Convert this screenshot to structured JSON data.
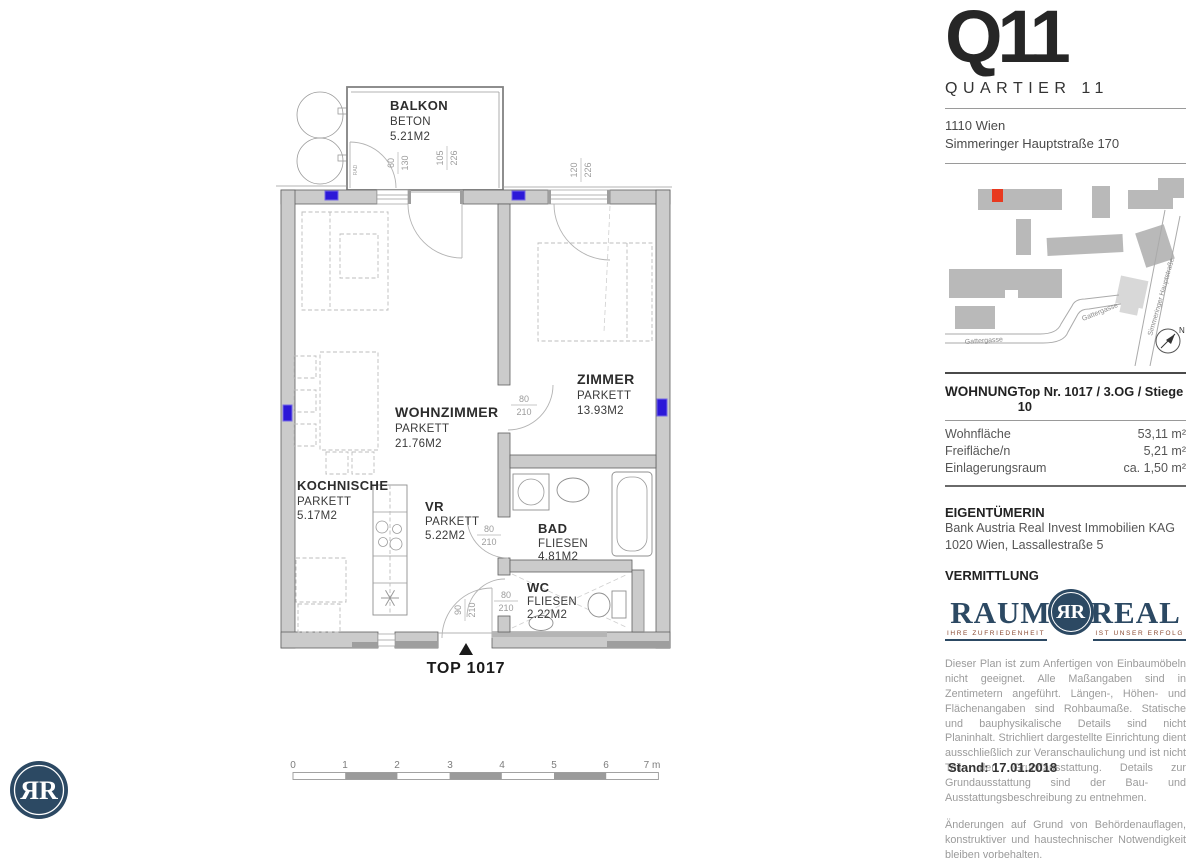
{
  "colors": {
    "brand_navy": "#2c4963",
    "marker_red": "#e8391f",
    "outlet_blue": "#2c18d8"
  },
  "header": {
    "logo": "Q11",
    "subtitle": "QUARTIER 11",
    "address_line1": "1110 Wien",
    "address_line2": "Simmeringer Hauptstraße 170"
  },
  "site_map": {
    "street_gattergasse_1": "Gattergasse",
    "street_gattergasse_2": "Gattergasse",
    "street_hauptstrasse": "Simmeringer Hauptstraße",
    "compass": "N"
  },
  "unit_info": {
    "section_label": "WOHNUNG",
    "unit_label": "Top Nr. 1017 / 3.OG / Stiege 10",
    "rows": [
      {
        "label": "Wohnfläche",
        "value": "53,11 m²"
      },
      {
        "label": "Freifläche/n",
        "value": "5,21 m²"
      },
      {
        "label": "Einlagerungsraum",
        "value": "ca. 1,50 m²"
      }
    ]
  },
  "owner": {
    "section_label": "EIGENTÜMERIN",
    "line1": "Bank Austria Real Invest Immobilien KAG",
    "line2": "1020 Wien, Lassallestraße 5"
  },
  "broker": {
    "section_label": "VERMITTLUNG",
    "logo_word_left": "RAUM",
    "logo_word_right": "REAL",
    "monogram": "ЯR",
    "tagline_left": "IHRE ZUFRIEDENHEIT",
    "tagline_right": "IST UNSER ERFOLG"
  },
  "disclaimer": {
    "paragraph1": "Dieser Plan ist zum Anfertigen von Einbaumöbeln nicht geeignet. Alle Maßangaben sind in Zentimetern angeführt. Längen-, Höhen- und Flächenangaben sind Rohbaumaße. Statische und bauphysikalische Details sind nicht Planinhalt. Strichliert dargestellte Einrichtung dient ausschließlich zur Veranschaulichung und ist nicht Teil der Grundausstattung. Details zur Grundausstattung sind der Bau- und Ausstattungsbeschreibung zu entnehmen.",
    "paragraph2": "Änderungen auf Grund von Behördenauflagen, konstruktiver und haustechnischer Notwendigkeit bleiben vorbehalten."
  },
  "footer": {
    "date": "Stand: 17.01.2018"
  },
  "floor_plan": {
    "unit_marker": "TOP 1017",
    "wall_label": "RAD",
    "rooms": [
      {
        "name": "BALKON",
        "floor": "BETON",
        "area": "5.21M2"
      },
      {
        "name": "WOHNZIMMER",
        "floor": "PARKETT",
        "area": "21.76M2"
      },
      {
        "name": "ZIMMER",
        "floor": "PARKETT",
        "area": "13.93M2"
      },
      {
        "name": "KOCHNISCHE",
        "floor": "PARKETT",
        "area": "5.17M2"
      },
      {
        "name": "VR",
        "floor": "PARKETT",
        "area": "5.22M2"
      },
      {
        "name": "BAD",
        "floor": "FLIESEN",
        "area": "4.81M2"
      },
      {
        "name": "WC",
        "floor": "FLIESEN",
        "area": "2.22M2"
      }
    ],
    "dims": {
      "balcony_window": {
        "w": "60",
        "h": "130"
      },
      "balcony_door": {
        "w": "105",
        "h": "226"
      },
      "zimmer_window": {
        "w": "120",
        "h": "226"
      },
      "zimmer_door": {
        "w": "80",
        "h": "210"
      },
      "bad_door": {
        "w": "80",
        "h": "210"
      },
      "wc_door": {
        "w": "80",
        "h": "210"
      },
      "entrance_door": {
        "w": "90",
        "h": "210"
      }
    },
    "scale_bar": {
      "ticks": [
        "0",
        "1",
        "2",
        "3",
        "4",
        "5",
        "6"
      ],
      "end_label": "7 m"
    }
  }
}
